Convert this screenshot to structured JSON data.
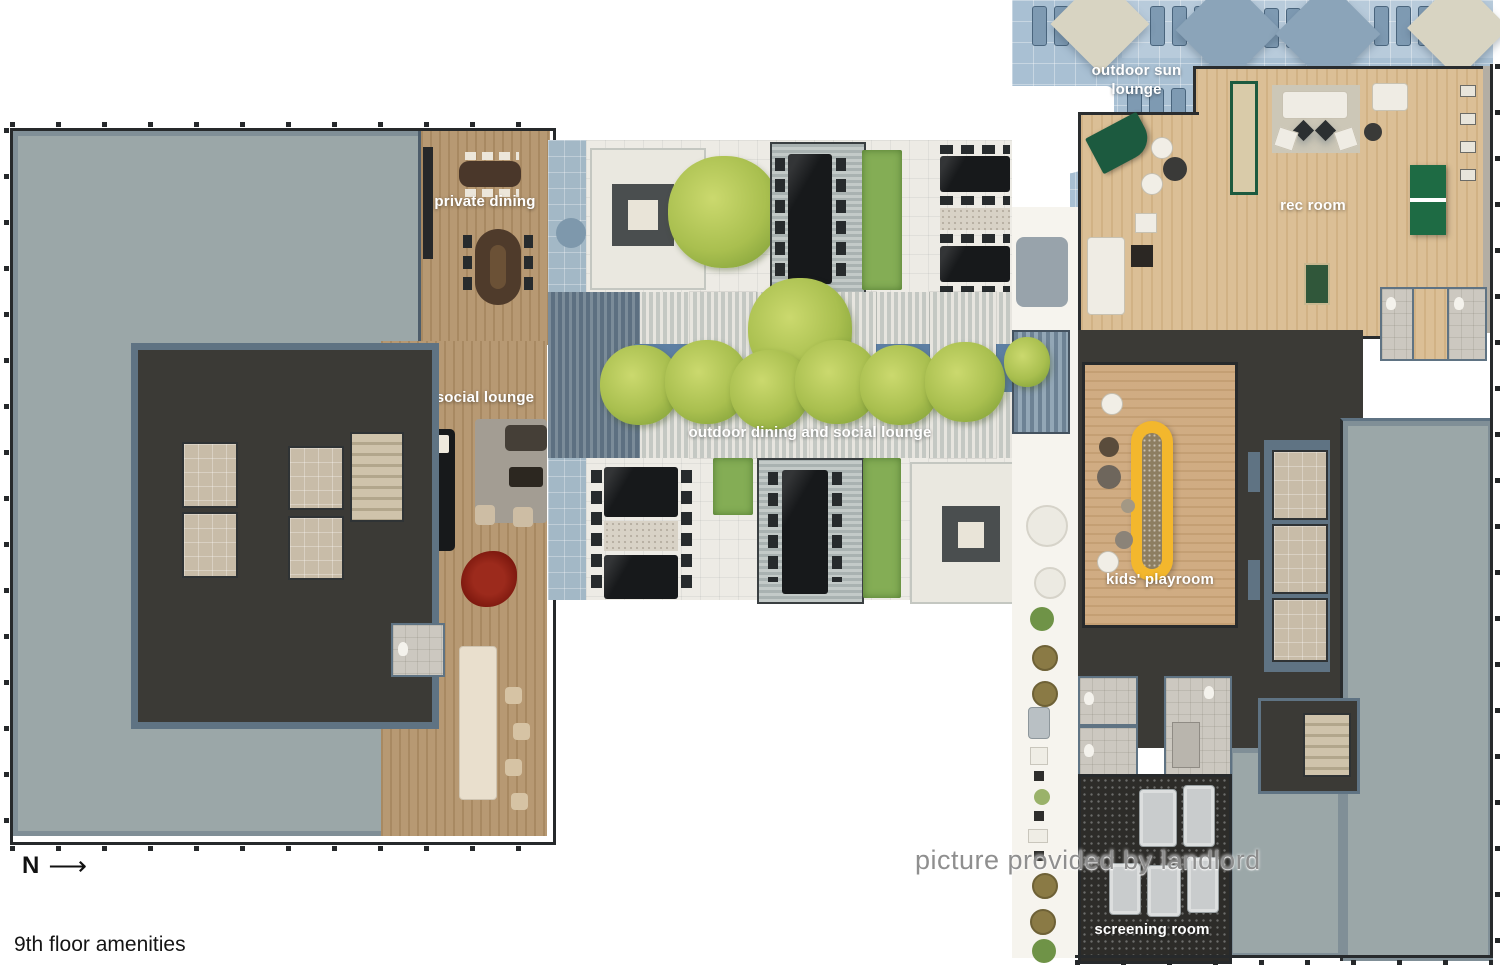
{
  "plan": {
    "rooms": [
      {
        "id": "private-dining",
        "label": "private dining"
      },
      {
        "id": "social-lounge",
        "label": "social lounge"
      },
      {
        "id": "outdoor-dining-social-lounge",
        "label": "outdoor dining and social lounge"
      },
      {
        "id": "outdoor-sun-lounge",
        "label": "outdoor sun lounge"
      },
      {
        "id": "rec-room",
        "label": "rec room"
      },
      {
        "id": "kids-playroom",
        "label": "kids' playroom"
      },
      {
        "id": "screening-room",
        "label": "screening room"
      }
    ]
  },
  "annotations": {
    "north_letter": "N",
    "north_arrow": "⟶",
    "caption": "9th floor amenities",
    "watermark": "picture provided by landlord"
  },
  "palette": {
    "background": "#ffffff",
    "roof_gray": "#9ba7a8",
    "wall_slate": "#5f7383",
    "outline_dark": "#26292b",
    "floor_charcoal": "#3b3a36",
    "wood_mid": "#b3946c",
    "wood_light": "#d9bb8f",
    "wood_kids": "#cda87c",
    "tile_white": "#edebe5",
    "tile_blue": "#a9c0d3",
    "water_blue": "#5d7fa3",
    "hedge_green": "#84ad55",
    "tree_green": "#a9bf4f",
    "play_structure_yellow": "#f3b72d",
    "table_black": "#17191b",
    "screening_carpet": "#2d2c29",
    "sofa_light_gray": "#c9cccd",
    "elevator_beige": "#c8bca8",
    "label_white": "#ffffff",
    "caption_black": "#151515",
    "watermark_gray": "#969696"
  }
}
